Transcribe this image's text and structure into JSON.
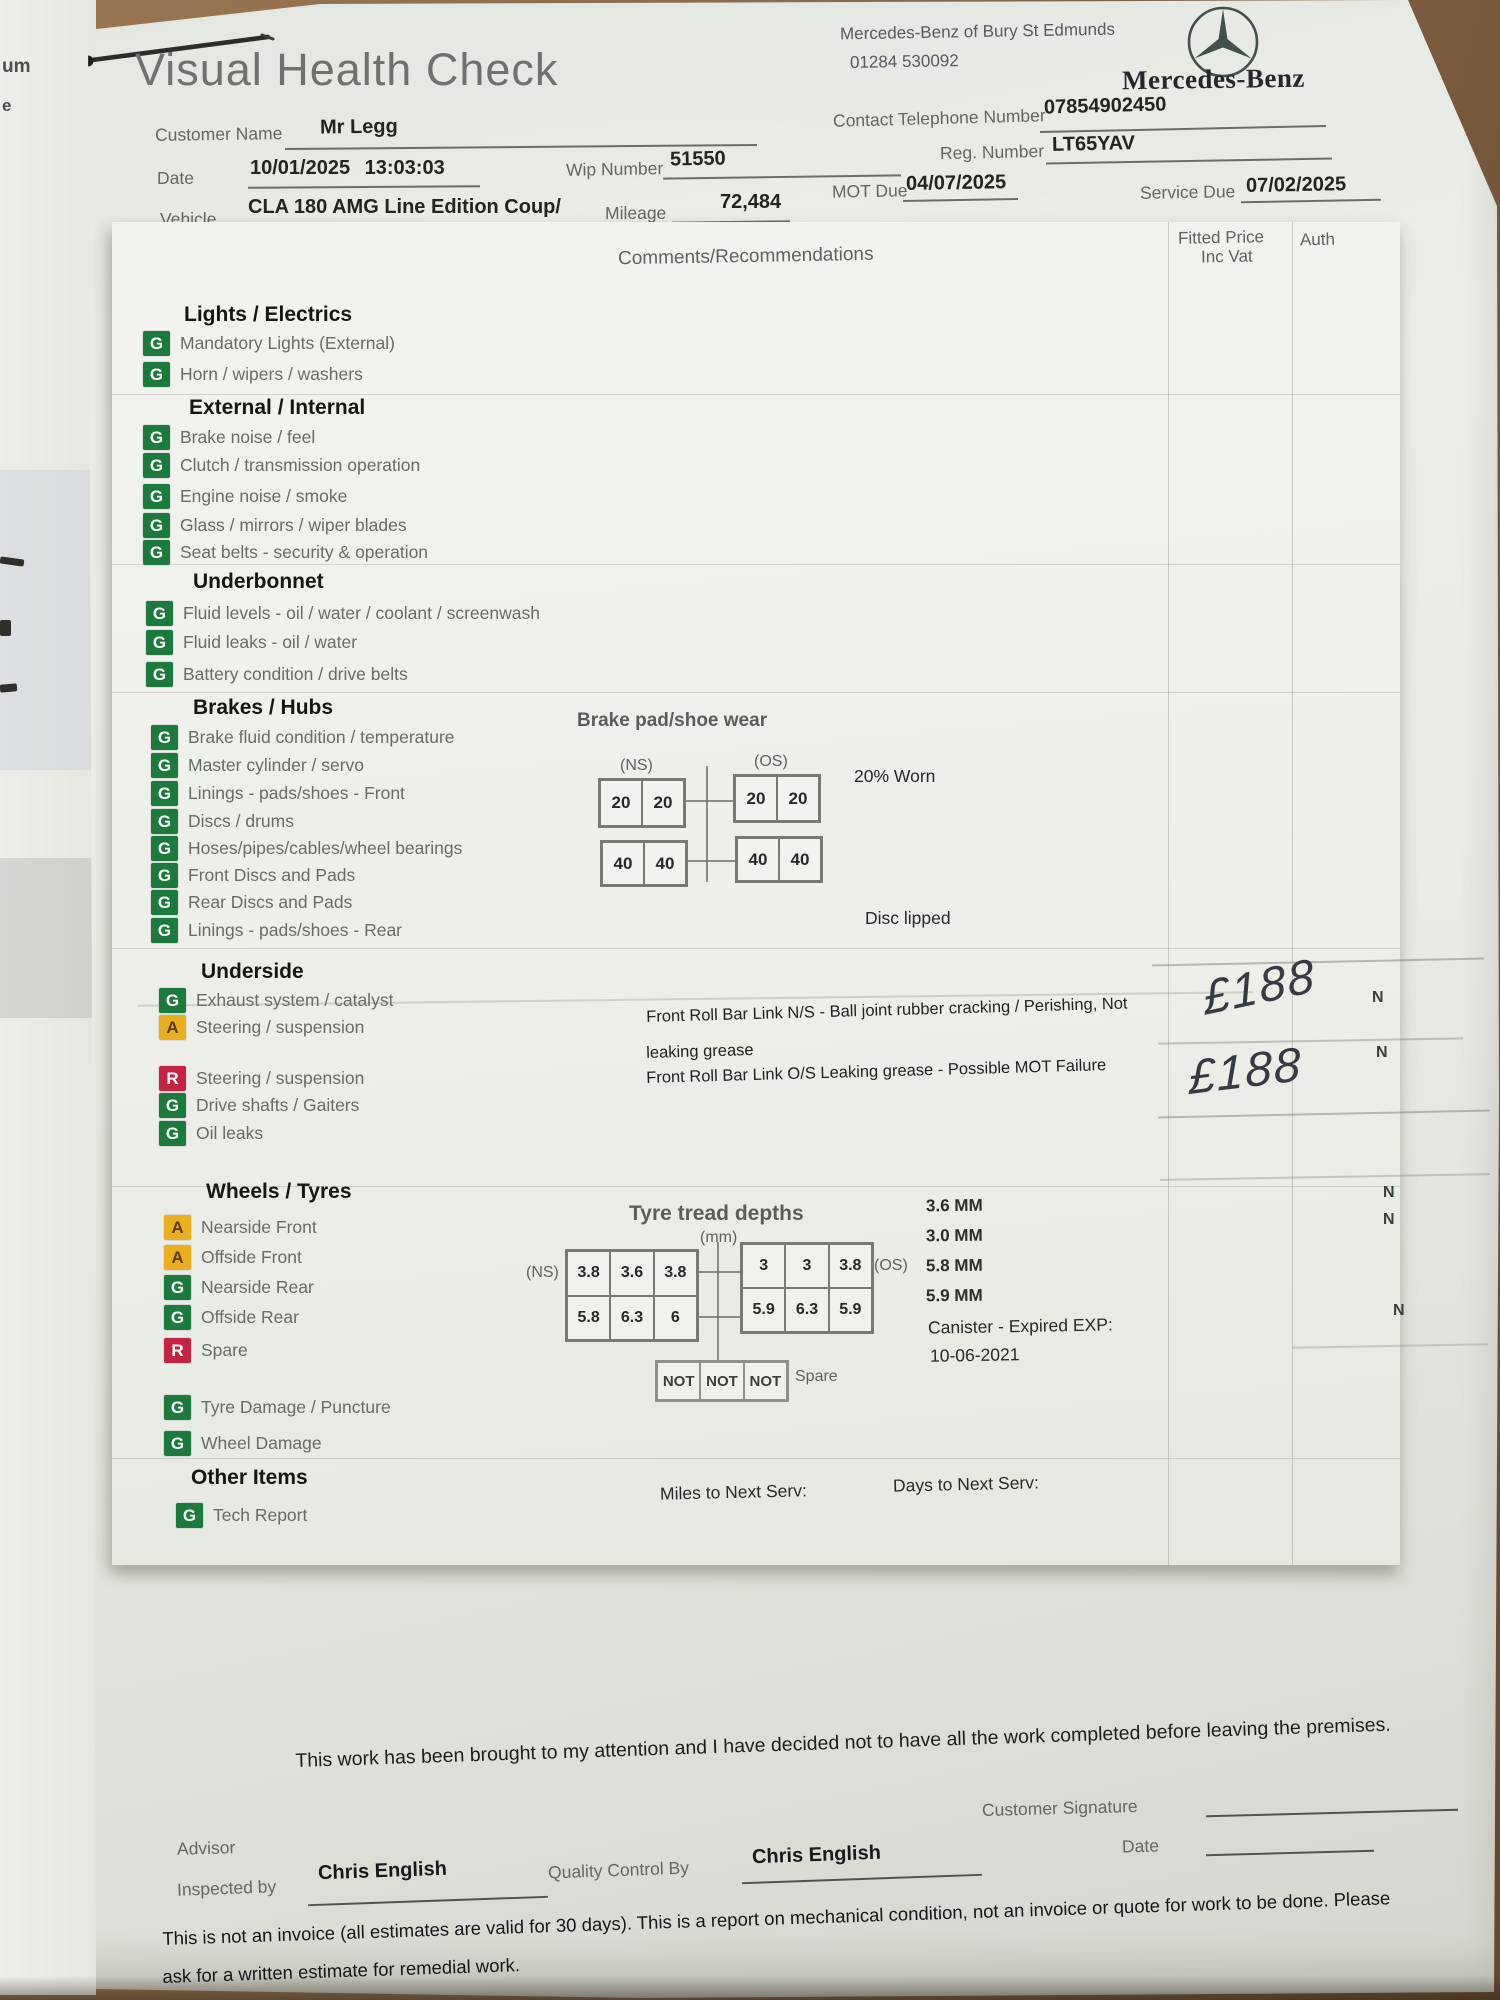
{
  "title": "Visual Health Check",
  "dealer": {
    "name": "Mercedes-Benz of Bury St Edmunds",
    "phone": "01284 530092",
    "wordmark": "Mercedes-Benz"
  },
  "fields": {
    "customer_label": "Customer Name",
    "customer": "Mr Legg",
    "contact_label": "Contact Telephone Number",
    "contact": "07854902450",
    "date_label": "Date",
    "date": "10/01/2025 13:03:03",
    "wip_label": "Wip Number",
    "wip": "51550",
    "reg_label": "Reg. Number",
    "reg": "LT65YAV",
    "vehicle_label": "Vehicle",
    "vehicle": "CLA 180 AMG Line Edition Coup/",
    "mileage_label": "Mileage",
    "mileage": "72,484",
    "mot_label": "MOT Due",
    "mot": "04/07/2025",
    "service_label": "Service Due",
    "service": "07/02/2025"
  },
  "table": {
    "comments_header": "Comments/Recommendations",
    "price_header_1": "Fitted Price",
    "price_header_2": "Inc Vat",
    "auth_header": "Auth"
  },
  "sections": [
    {
      "title": "Lights / Electrics",
      "items": [
        {
          "status": "G",
          "label": "Mandatory Lights (External)"
        },
        {
          "status": "G",
          "label": "Horn / wipers / washers"
        }
      ]
    },
    {
      "title": "External / Internal",
      "items": [
        {
          "status": "G",
          "label": "Brake noise / feel"
        },
        {
          "status": "G",
          "label": "Clutch / transmission operation"
        },
        {
          "status": "G",
          "label": "Engine noise / smoke"
        },
        {
          "status": "G",
          "label": "Glass / mirrors / wiper blades"
        },
        {
          "status": "G",
          "label": "Seat belts - security & operation"
        }
      ]
    },
    {
      "title": "Underbonnet",
      "items": [
        {
          "status": "G",
          "label": "Fluid levels - oil / water / coolant / screenwash"
        },
        {
          "status": "G",
          "label": "Fluid leaks - oil / water"
        },
        {
          "status": "G",
          "label": "Battery condition / drive belts"
        }
      ]
    },
    {
      "title": "Brakes / Hubs",
      "items": [
        {
          "status": "G",
          "label": "Brake fluid condition / temperature"
        },
        {
          "status": "G",
          "label": "Master cylinder / servo"
        },
        {
          "status": "G",
          "label": "Linings - pads/shoes - Front"
        },
        {
          "status": "G",
          "label": "Discs / drums"
        },
        {
          "status": "G",
          "label": "Hoses/pipes/cables/wheel bearings"
        },
        {
          "status": "G",
          "label": "Front Discs and Pads"
        },
        {
          "status": "G",
          "label": "Rear Discs and Pads"
        },
        {
          "status": "G",
          "label": "Linings - pads/shoes - Rear"
        }
      ]
    },
    {
      "title": "Underside",
      "items": [
        {
          "status": "G",
          "label": "Exhaust system / catalyst"
        },
        {
          "status": "A",
          "label": "Steering / suspension"
        },
        {
          "status": "R",
          "label": "Steering / suspension"
        },
        {
          "status": "G",
          "label": "Drive shafts / Gaiters"
        },
        {
          "status": "G",
          "label": "Oil leaks"
        }
      ]
    },
    {
      "title": "Wheels / Tyres",
      "items": [
        {
          "status": "A",
          "label": "Nearside Front"
        },
        {
          "status": "A",
          "label": "Offside Front"
        },
        {
          "status": "G",
          "label": "Nearside Rear"
        },
        {
          "status": "G",
          "label": "Offside Rear"
        },
        {
          "status": "R",
          "label": "Spare"
        },
        {
          "status": "G",
          "label": "Tyre Damage / Puncture"
        },
        {
          "status": "G",
          "label": "Wheel Damage"
        }
      ]
    },
    {
      "title": "Other Items",
      "items": [
        {
          "status": "G",
          "label": "Tech Report"
        }
      ]
    }
  ],
  "brake_wear": {
    "title": "Brake pad/shoe wear",
    "ns": "(NS)",
    "os": "(OS)",
    "ns_top": [
      "20",
      "20"
    ],
    "os_top": [
      "20",
      "20"
    ],
    "ns_bottom": [
      "40",
      "40"
    ],
    "os_bottom": [
      "40",
      "40"
    ],
    "worn_note": "20% Worn",
    "disc_note": "Disc lipped"
  },
  "comments": {
    "line1": "Front Roll Bar Link N/S - Ball joint rubber cracking / Perishing, Not",
    "line2": "leaking grease",
    "line3": "Front Roll Bar Link O/S Leaking grease - Possible MOT Failure"
  },
  "handwritten": {
    "price1": "£188",
    "price2": "£188"
  },
  "auth_marks": [
    "N",
    "N",
    "N",
    "N",
    "N"
  ],
  "tyres": {
    "title": "Tyre tread depths",
    "unit": "(mm)",
    "ns": "(NS)",
    "os": "(OS)",
    "ns_values": [
      "3.8",
      "3.6",
      "3.8",
      "5.8",
      "6.3",
      "6"
    ],
    "os_values": [
      "3",
      "3",
      "3.8",
      "5.9",
      "6.3",
      "5.9"
    ],
    "spare_values": [
      "NOT",
      "NOT",
      "NOT"
    ],
    "spare_label": "Spare",
    "readings": [
      "3.6 MM",
      "3.0 MM",
      "5.8 MM",
      "5.9 MM"
    ],
    "canister_1": "Canister - Expired EXP:",
    "canister_2": "10-06-2021"
  },
  "next_service": {
    "miles_label": "Miles to Next Serv:",
    "days_label": "Days to Next Serv:"
  },
  "footer": {
    "declaration": "This work has been brought to my attention and I have decided not to have all the work completed before leaving the premises.",
    "customer_signature_label": "Customer Signature",
    "advisor_label": "Advisor",
    "date_label": "Date",
    "inspected_by_label": "Inspected by",
    "inspected_by": "Chris English",
    "qc_label": "Quality Control By",
    "qc": "Chris English",
    "disclaimer_line1": "This is not an invoice (all estimates are valid for 30 days). This is a report on mechanical condition, not an invoice or quote for work to be done. Please",
    "disclaimer_line2": "ask for a written estimate for remedial work."
  },
  "fragments": {
    "f1": "um",
    "f2": "e"
  },
  "colors": {
    "green": "#1c7a3c",
    "amber": "#e9af1e",
    "red": "#c32442",
    "wood": "#8a6a4c"
  }
}
